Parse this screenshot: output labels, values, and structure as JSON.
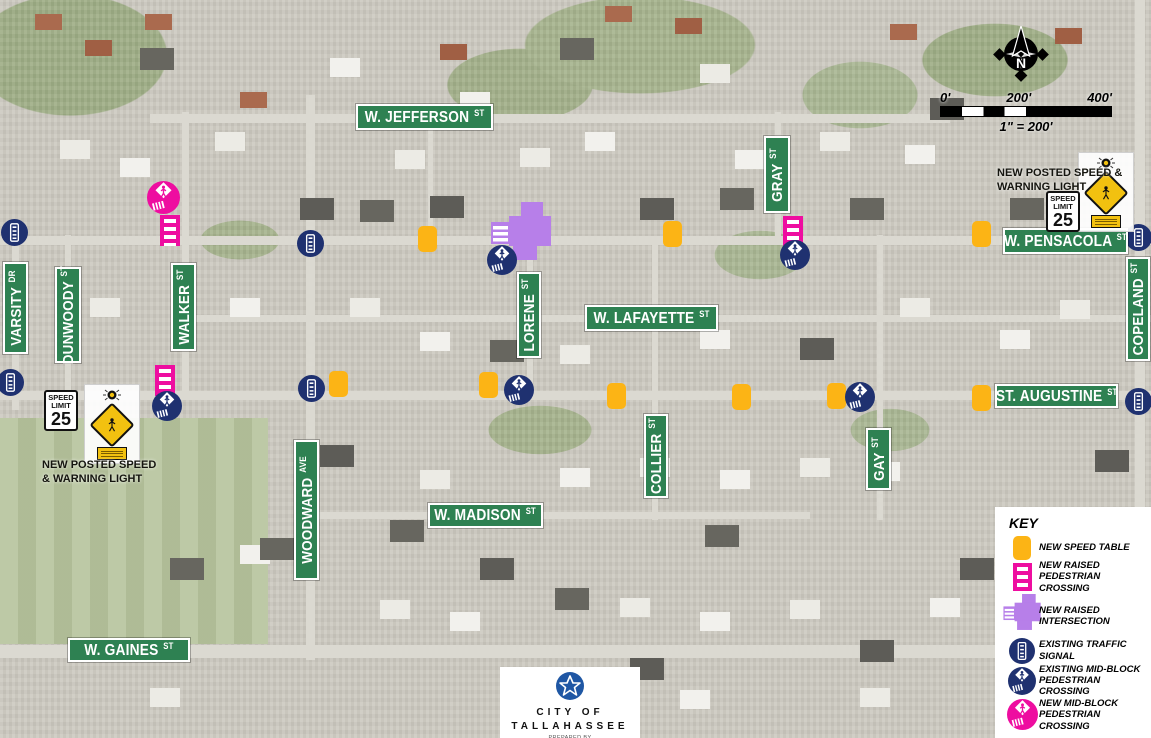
{
  "colors": {
    "street_sign_green": "#2e8152",
    "speed_table_yellow": "#fcb415",
    "new_pink": "#ee0da0",
    "raised_intersection_purple": "#b77fe9",
    "existing_navy": "#1f3170",
    "warning_yellow": "#f2c110"
  },
  "map": {
    "streets_horizontal": [
      {
        "name": "W. JEFFERSON",
        "suffix": "ST",
        "x": 356,
        "y": 104,
        "w": 137,
        "h": 26
      },
      {
        "name": "W. PENSACOLA",
        "suffix": "ST",
        "x": 1003,
        "y": 228,
        "w": 125,
        "h": 26
      },
      {
        "name": "W. LAFAYETTE",
        "suffix": "ST",
        "x": 585,
        "y": 305,
        "w": 133,
        "h": 26
      },
      {
        "name": "ST. AUGUSTINE",
        "suffix": "ST",
        "x": 995,
        "y": 384,
        "w": 123,
        "h": 24
      },
      {
        "name": "W. MADISON",
        "suffix": "ST",
        "x": 428,
        "y": 503,
        "w": 115,
        "h": 25
      },
      {
        "name": "W. GAINES",
        "suffix": "ST",
        "x": 68,
        "y": 638,
        "w": 122,
        "h": 24
      }
    ],
    "streets_vertical": [
      {
        "name": "VARSITY",
        "suffix": "DR",
        "x": 3,
        "y": 262,
        "w": 25,
        "h": 92
      },
      {
        "name": "DUNWOODY",
        "suffix": "ST",
        "x": 55,
        "y": 267,
        "w": 26,
        "h": 96
      },
      {
        "name": "WALKER",
        "suffix": "ST",
        "x": 171,
        "y": 263,
        "w": 25,
        "h": 88
      },
      {
        "name": "GRAY",
        "suffix": "ST",
        "x": 764,
        "y": 136,
        "w": 26,
        "h": 77
      },
      {
        "name": "LORENE",
        "suffix": "ST",
        "x": 517,
        "y": 272,
        "w": 24,
        "h": 86
      },
      {
        "name": "COLLIER",
        "suffix": "ST",
        "x": 644,
        "y": 414,
        "w": 24,
        "h": 84
      },
      {
        "name": "GAY",
        "suffix": "ST",
        "x": 866,
        "y": 428,
        "w": 25,
        "h": 62
      },
      {
        "name": "WOODWARD",
        "suffix": "AVE",
        "x": 294,
        "y": 440,
        "w": 25,
        "h": 140
      },
      {
        "name": "COPELAND",
        "suffix": "ST",
        "x": 1126,
        "y": 257,
        "w": 24,
        "h": 104
      }
    ],
    "markers": {
      "speed_tables": [
        {
          "x": 427,
          "y": 239
        },
        {
          "x": 672,
          "y": 234
        },
        {
          "x": 981,
          "y": 234
        },
        {
          "x": 338,
          "y": 384
        },
        {
          "x": 488,
          "y": 385
        },
        {
          "x": 616,
          "y": 396
        },
        {
          "x": 741,
          "y": 397
        },
        {
          "x": 836,
          "y": 396
        },
        {
          "x": 981,
          "y": 398
        }
      ],
      "raised_crossings": [
        {
          "x": 170,
          "y": 230
        },
        {
          "x": 793,
          "y": 231
        },
        {
          "x": 165,
          "y": 380
        }
      ],
      "raised_intersection": {
        "x": 521,
        "y": 233
      },
      "traffic_signals": [
        {
          "x": 14,
          "y": 232
        },
        {
          "x": 10,
          "y": 382
        },
        {
          "x": 310,
          "y": 243
        },
        {
          "x": 311,
          "y": 388
        },
        {
          "x": 1138,
          "y": 237
        },
        {
          "x": 1138,
          "y": 401
        }
      ],
      "existing_midblock_crossings": [
        {
          "x": 502,
          "y": 260
        },
        {
          "x": 795,
          "y": 255
        },
        {
          "x": 519,
          "y": 390
        },
        {
          "x": 860,
          "y": 397
        },
        {
          "x": 167,
          "y": 406
        }
      ],
      "new_midblock_crossings": [
        {
          "x": 163,
          "y": 197
        }
      ]
    },
    "speed_notes": [
      {
        "note": "NEW POSTED SPEED\n& WARNING LIGHT",
        "note_x": 42,
        "note_y": 458,
        "sign_x": 44,
        "sign_y": 390,
        "panel_x": 84,
        "panel_y": 384
      },
      {
        "note": "NEW POSTED SPEED &\nWARNING LIGHT",
        "note_x": 997,
        "note_y": 166,
        "sign_x": 1046,
        "sign_y": 191,
        "panel_x": 1078,
        "panel_y": 152
      }
    ],
    "speed_sign": {
      "top": "SPEED",
      "mid": "LIMIT",
      "value": "25"
    }
  },
  "north": {
    "label": "N"
  },
  "scale_bar": {
    "ticks": [
      "0'",
      "200'",
      "400'"
    ],
    "ratio": "1\" = 200'"
  },
  "legend": {
    "title": "KEY",
    "items": [
      {
        "icon": "speed-table",
        "label": "NEW SPEED TABLE"
      },
      {
        "icon": "raised-pedestrian-crossing",
        "label": "NEW RAISED\nPEDESTRIAN CROSSING"
      },
      {
        "icon": "raised-intersection",
        "label": "NEW RAISED\nINTERSECTION"
      },
      {
        "icon": "traffic-signal",
        "label": "EXISTING TRAFFIC SIGNAL"
      },
      {
        "icon": "existing-mid-block-crossing",
        "label": "EXISTING MID-BLOCK\nPEDESTRIAN CROSSING"
      },
      {
        "icon": "new-mid-block-crossing",
        "label": "NEW MID-BLOCK\nPEDESTRIAN CROSSING"
      }
    ]
  },
  "logo": {
    "city_top": "CITY OF",
    "city_bottom": "TALLAHASSEE",
    "prepared": "PREPARED BY",
    "org": "PUBLIC INFRASTRUCTURE ENGINEERING"
  }
}
